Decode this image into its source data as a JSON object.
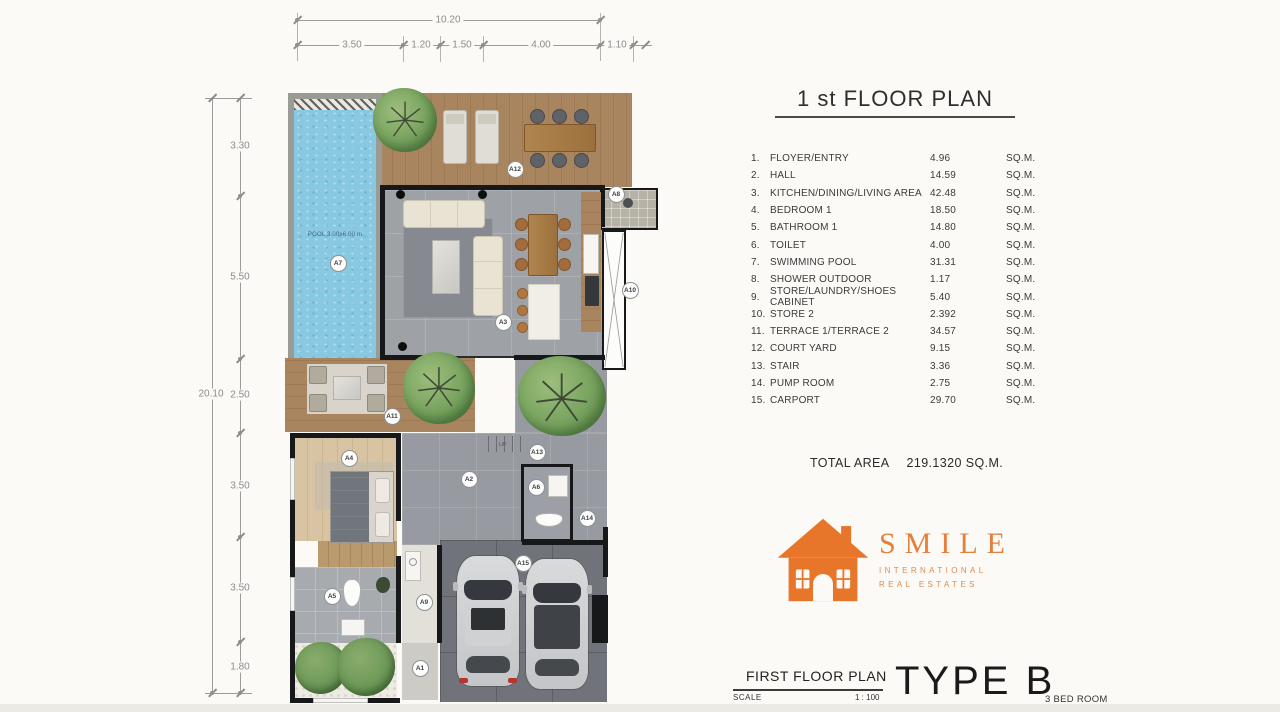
{
  "header": {
    "title": "1 st FLOOR PLAN"
  },
  "rooms": [
    {
      "num": "1.",
      "name": "FLOYER/ENTRY",
      "area": "4.96",
      "unit": "SQ.M."
    },
    {
      "num": "2.",
      "name": "HALL",
      "area": "14.59",
      "unit": "SQ.M."
    },
    {
      "num": "3.",
      "name": "KITCHEN/DINING/LIVING AREA",
      "area": "42.48",
      "unit": "SQ.M."
    },
    {
      "num": "4.",
      "name": "BEDROOM 1",
      "area": "18.50",
      "unit": "SQ.M."
    },
    {
      "num": "5.",
      "name": "BATHROOM 1",
      "area": "14.80",
      "unit": "SQ.M."
    },
    {
      "num": "6.",
      "name": "TOILET",
      "area": "4.00",
      "unit": "SQ.M."
    },
    {
      "num": "7.",
      "name": "SWIMMING POOL",
      "area": "31.31",
      "unit": "SQ.M."
    },
    {
      "num": "8.",
      "name": "SHOWER OUTDOOR",
      "area": "1.17",
      "unit": "SQ.M."
    },
    {
      "num": "9.",
      "name": "STORE/LAUNDRY/SHOES CABINET",
      "area": "5.40",
      "unit": "SQ.M."
    },
    {
      "num": "10.",
      "name": "STORE 2",
      "area": "2.392",
      "unit": "SQ.M."
    },
    {
      "num": "11.",
      "name": "TERRACE 1/TERRACE 2",
      "area": "34.57",
      "unit": "SQ.M."
    },
    {
      "num": "12.",
      "name": "COURT YARD",
      "area": "9.15",
      "unit": "SQ.M."
    },
    {
      "num": "13.",
      "name": "STAIR",
      "area": "3.36",
      "unit": "SQ.M."
    },
    {
      "num": "14.",
      "name": "PUMP ROOM",
      "area": "2.75",
      "unit": "SQ.M."
    },
    {
      "num": "15.",
      "name": "CARPORT",
      "area": "29.70",
      "unit": "SQ.M."
    }
  ],
  "total": {
    "label": "TOTAL AREA",
    "value": "219.1320 SQ.M."
  },
  "logo": {
    "brand": "SMILE",
    "line1": "INTERNATIONAL",
    "line2": "REAL ESTATES",
    "color": "#E8762A"
  },
  "title_block": {
    "plan_name": "FIRST FLOOR PLAN",
    "scale_label": "SCALE",
    "scale_value": "1 : 100",
    "type_label": "TYPE B",
    "bed_label": "3 BED ROOM"
  },
  "dimensions": {
    "top_total": "10.20",
    "top_segments": [
      "3.50",
      "1.20",
      "1.50",
      "4.00",
      "1.10"
    ],
    "left_total": "20.10",
    "left_segments": [
      "3.30",
      "5.50",
      "2.50",
      "3.50",
      "3.50",
      "1.80"
    ]
  },
  "plan": {
    "pool_text": "POOL 3.00x6.00 m.",
    "up_text": "UP",
    "markers": [
      "A1",
      "A2",
      "A3",
      "A4",
      "A5",
      "A6",
      "A7",
      "A8",
      "A9",
      "A10",
      "A11",
      "A12",
      "A13",
      "A14",
      "A15"
    ]
  },
  "colors": {
    "pool": "#88C8E0",
    "deck_wood": "#A9855F",
    "living_floor": "#9EA2A7",
    "carport_floor": "#70747A",
    "wall": "#17181A",
    "brand_orange": "#E8762A"
  }
}
